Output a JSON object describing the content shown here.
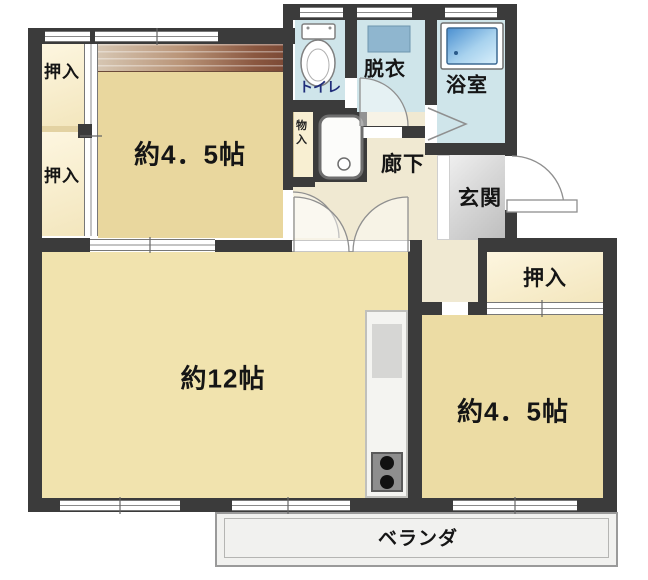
{
  "title": "2DK apartment floor plan",
  "rooms": {
    "closet_top_left": {
      "label": "押入"
    },
    "closet_bottom_left": {
      "label": "押入"
    },
    "bedroom_top": {
      "label": "約4．5帖"
    },
    "toilet": {
      "label": "トイレ"
    },
    "dressing": {
      "label": "脱衣"
    },
    "bath": {
      "label": "浴室"
    },
    "storage": {
      "label": "物入"
    },
    "hallway": {
      "label": "廊下"
    },
    "entrance": {
      "label": "玄関"
    },
    "closet_right": {
      "label": "押入"
    },
    "living": {
      "label": "約12帖"
    },
    "bedroom_right": {
      "label": "約4．5帖"
    },
    "veranda": {
      "label": "ベランダ"
    }
  },
  "fixtures": {
    "toilet_icon": "western-toilet",
    "washbasin_icon": "washbasin",
    "bathtub_icon": "bathtub",
    "vanity_sink_icon": "sink",
    "stove_icon": "two-burner-stove"
  },
  "colors": {
    "wall": "#3b3b3b",
    "roomTop": "#e9d79e",
    "room12": "#f1e3ae",
    "roomBR": "#ecdca4",
    "closet": "#f3e6bd",
    "corridor": "#f0e9d2",
    "wet": "#cfe5ea",
    "genkan": "#d9d9d9",
    "veranda": "#f1f1ef",
    "sinkBlue": "#8fb6cf",
    "tubBlue": "#4a8fd0",
    "toiletText": "#1f2d7a",
    "wood": "#9a6a50"
  }
}
